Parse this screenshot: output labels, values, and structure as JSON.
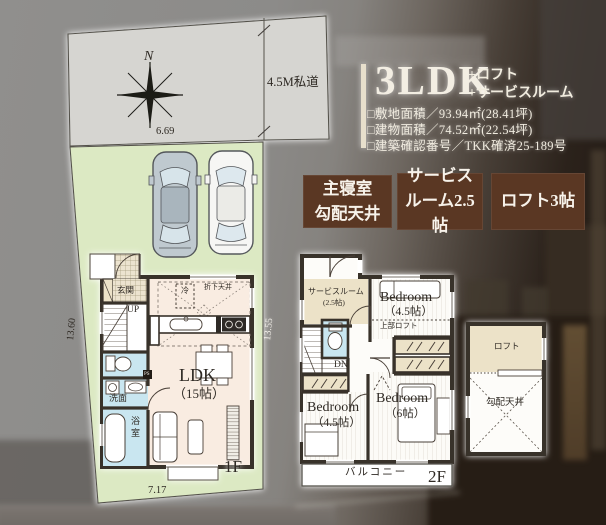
{
  "title": {
    "main": "3LDK",
    "sub1": "+ロフト",
    "sub2": "+サービスルーム",
    "specs": [
      "□敷地面積／93.94㎡(28.41坪)",
      "□建物面積／74.52㎡(22.54坪)",
      "□建築確認番号／TKK確済25-189号"
    ]
  },
  "badges": [
    {
      "line1": "主寝室",
      "line2": "勾配天井"
    },
    {
      "line1": "サービス",
      "line2": "ルーム2.5帖"
    },
    {
      "line1": "ロフト3帖",
      "line2": ""
    }
  ],
  "site": {
    "north": "N",
    "road_label": "4.5M私道",
    "dim_top": "6.69",
    "dim_left": "13.60",
    "dim_bottom": "7.17",
    "dim_2f_left": "13.55"
  },
  "floor1": {
    "label": "1F",
    "genkan": "玄関",
    "up": "UP",
    "senmen": "洗面",
    "yokushitsu": "浴室",
    "ldk": "LDK",
    "ldk_size": "（15帖）",
    "refrigerator": "冷",
    "dropped_ceiling": "折下天井",
    "ps": "PS"
  },
  "floor2": {
    "label": "2F",
    "service_room": "サービスルーム",
    "service_size": "(2.5帖)",
    "bedroom1": "Bedroom",
    "bedroom1_size": "（4.5帖）",
    "upper_loft": "上部ロフト",
    "dn": "DN",
    "bedroom2": "Bedroom",
    "bedroom2_size": "（4.5帖）",
    "bedroom3": "Bedroom",
    "bedroom3_size": "（6帖）",
    "balcony": "バルコニー"
  },
  "loft": {
    "label": "ロフト",
    "ceiling": "勾配天井"
  },
  "colors": {
    "badge_brown": "#5a3723",
    "site_green": "#dce9c3",
    "road_gray": "#d6d5d1",
    "water_blue": "#c9e6f0",
    "ldk_floor": "#f9ece1",
    "beige": "#ece2c8",
    "wall": "#38302a",
    "title_cream": "#f3eee3"
  }
}
